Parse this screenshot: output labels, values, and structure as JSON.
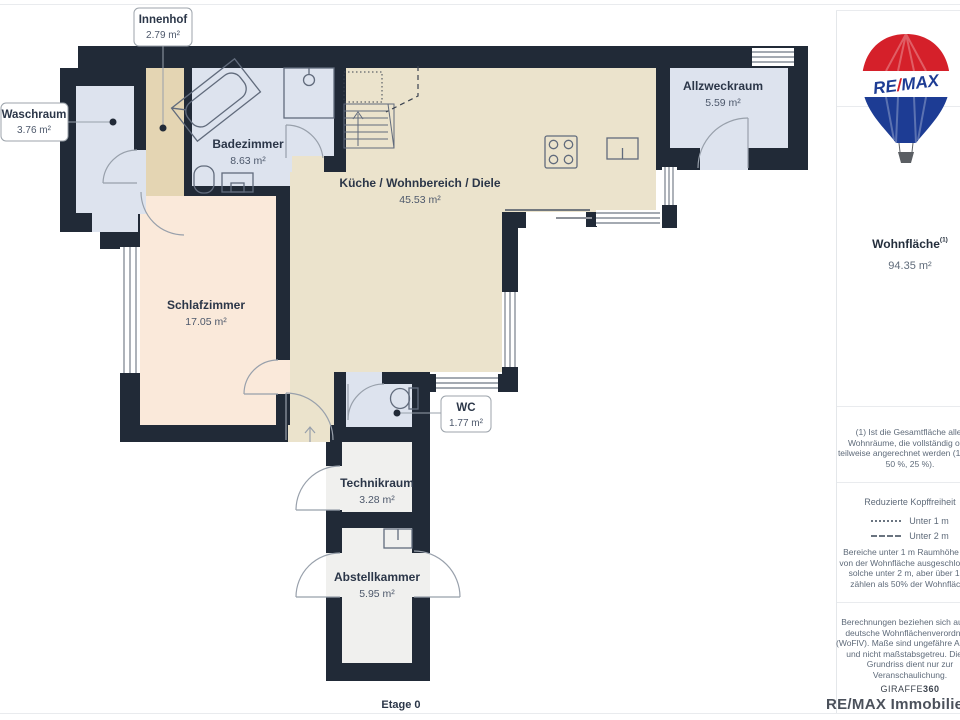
{
  "floor_plan": {
    "rooms": {
      "innenhof": {
        "name": "Innenhof",
        "area": "2.79 m²"
      },
      "waschraum": {
        "name": "Waschraum",
        "area": "3.76 m²"
      },
      "badezimmer": {
        "name": "Badezimmer",
        "area": "8.63 m²"
      },
      "kueche": {
        "name": "Küche / Wohnbereich / Diele",
        "area": "45.53 m²"
      },
      "allzweckraum": {
        "name": "Allzweckraum",
        "area": "5.59 m²"
      },
      "schlafzimmer": {
        "name": "Schlafzimmer",
        "area": "17.05 m²"
      },
      "wc": {
        "name": "WC",
        "area": "1.77 m²"
      },
      "technikraum": {
        "name": "Technikraum",
        "area": "3.28 m²"
      },
      "abstellkammer": {
        "name": "Abstellkammer",
        "area": "5.95 m²"
      }
    },
    "floor_label": "Etage 0"
  },
  "sidebar": {
    "logo": {
      "re": "RE",
      "slash": "/",
      "max": "MAX"
    },
    "wohnflaeche": {
      "label": "Wohnfläche",
      "sup": "(1)",
      "value": "94.35 m²"
    },
    "footnote_lines": [
      "(1) Ist die Gesamtfläche aller",
      "Wohnräume, die vollständig oder",
      "teilweise angerechnet werden (100 %,",
      "50 %, 25 %)."
    ],
    "kopffreiheit": {
      "title": "Reduzierte Kopffreiheit",
      "legend": [
        {
          "style": "dotted",
          "label": "Unter 1 m"
        },
        {
          "style": "dashed",
          "label": "Unter 2 m"
        }
      ],
      "body_lines": [
        "Bereiche unter 1 m Raumhöhe sind",
        "von der Wohnfläche ausgeschlossen,",
        "solche unter 2 m, aber über 1 m,",
        "zählen als 50% der Wohnfläche"
      ]
    },
    "disclaimer_lines": [
      "Berechnungen beziehen sich auf die",
      "deutsche Wohnflächenverordnung",
      "(WoFlV). Maße sind ungefähre Angaben",
      "und nicht maßstabsgetreu. Dieser",
      "Grundriss dient nur zur",
      "Veranschaulichung."
    ],
    "brand_footer": {
      "giraffe": "GIRAFFE",
      "num": "360"
    },
    "watermark": "RE/MAX Immobilien Del"
  },
  "colors": {
    "wall": "#212a37",
    "room_blue": "#dde3ee",
    "room_beige": "#ebe3cc",
    "room_peach": "#fae9da",
    "room_tan": "#e4d5b3",
    "room_gray": "#f0f0ee",
    "brand_red": "#e11b22",
    "brand_blue": "#1d3c94",
    "text_dark": "#2b3648"
  }
}
